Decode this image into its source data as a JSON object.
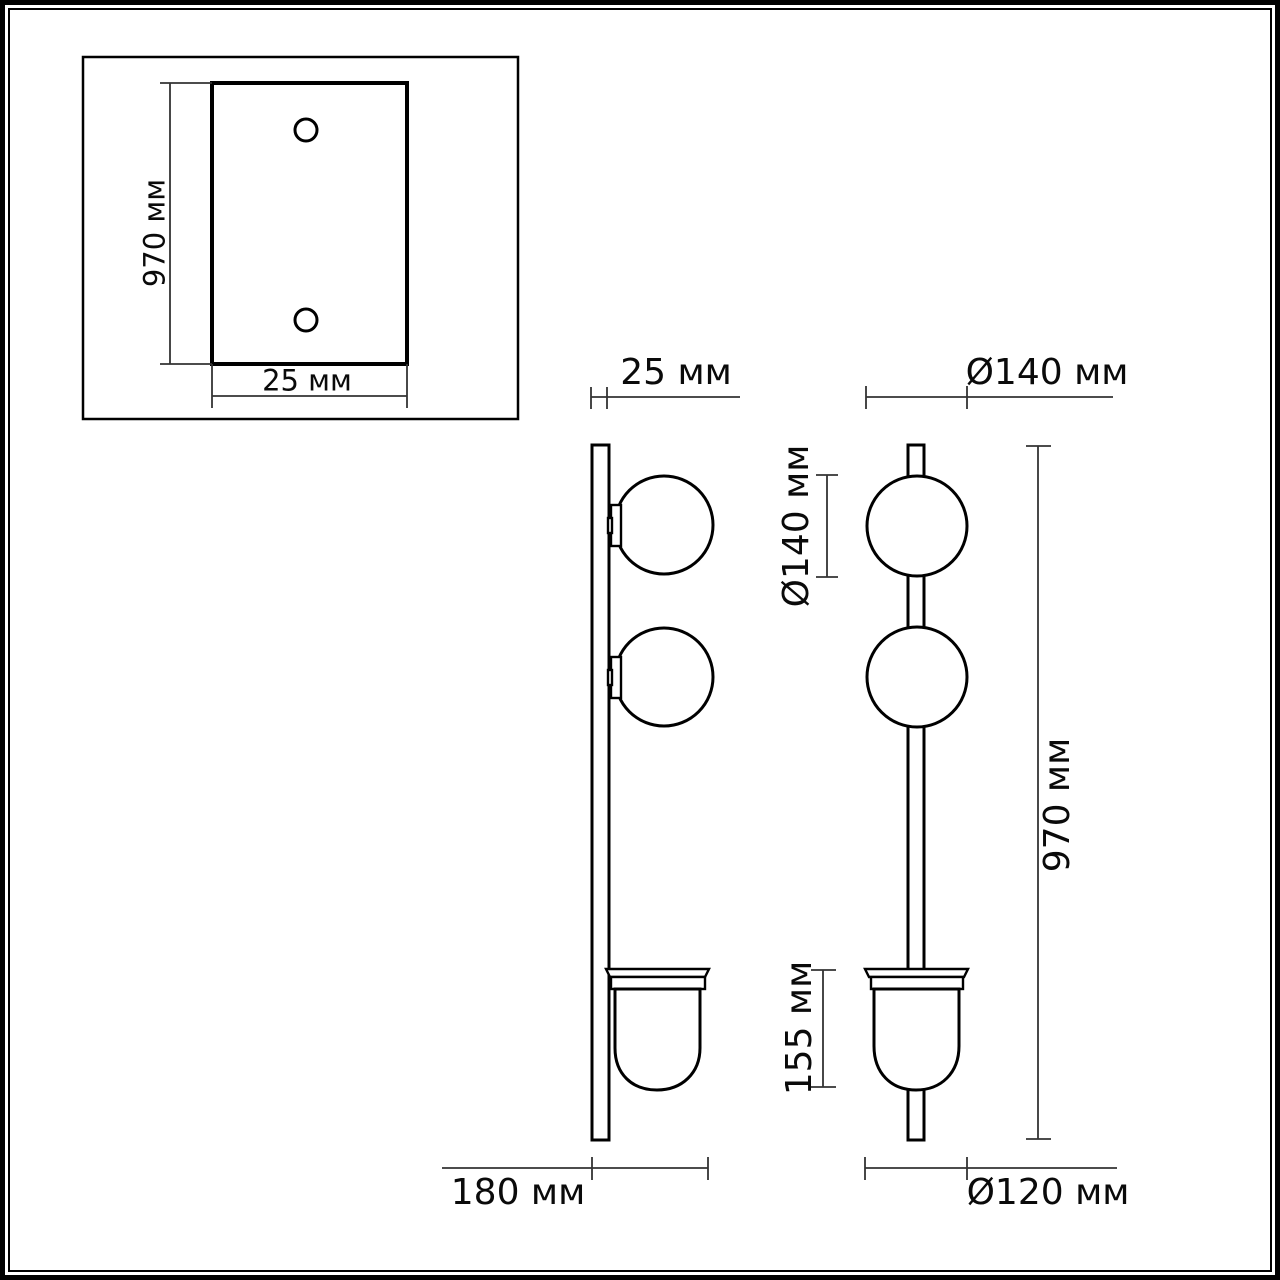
{
  "colors": {
    "line": "#000000",
    "dimension_line": "#333333",
    "background": "#ffffff"
  },
  "unit": "мм",
  "views": {
    "mounting_plate_inset": {
      "height_label": "970 мм",
      "width_label": "25 мм"
    },
    "side_view": {
      "bar_width_label": "25 мм",
      "depth_label": "180 мм"
    },
    "front_view": {
      "sphere_diameter_top_label": "Ø140 мм",
      "sphere_diameter_vertical_label": "Ø140 мм",
      "overall_height_label": "970 мм",
      "shade_height_label": "155 мм",
      "shade_diameter_label": "Ø120 мм"
    }
  }
}
